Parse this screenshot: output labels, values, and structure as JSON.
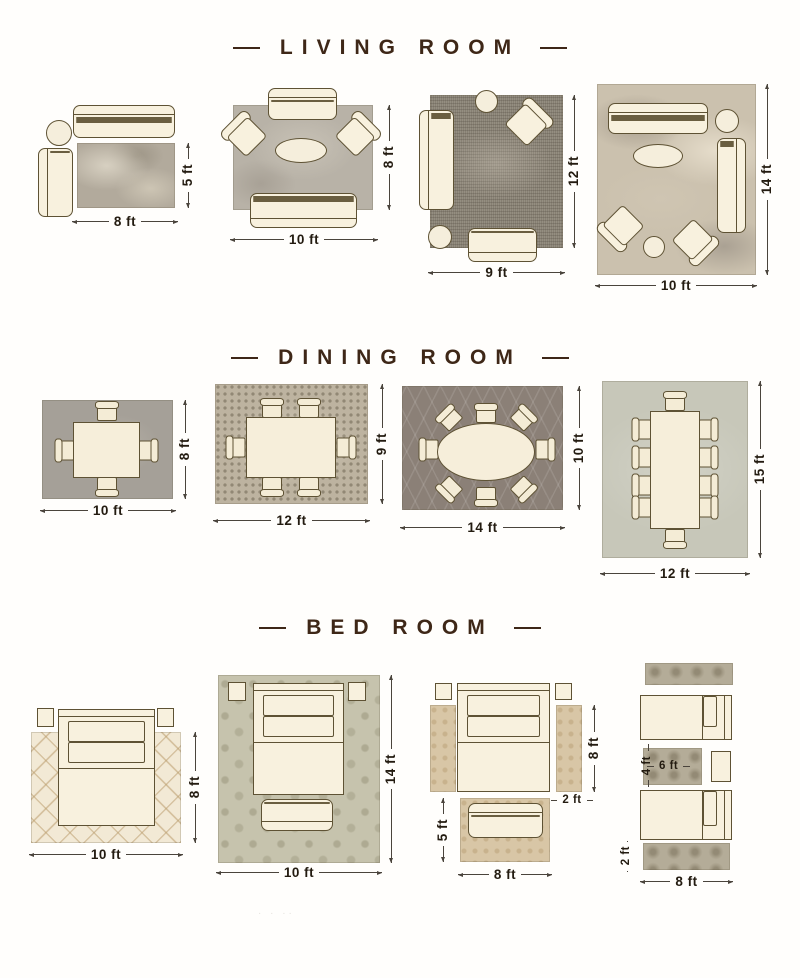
{
  "watermark": "· · ··",
  "sections": [
    {
      "title": "LIVING ROOM",
      "layouts": [
        {
          "width_label": "8 ft",
          "height_label": "5 ft",
          "furniture": [
            "sofa-3-seat",
            "round-side-table",
            "chaise"
          ],
          "rug_style": "gray-abstract"
        },
        {
          "width_label": "10 ft",
          "height_label": "8 ft",
          "furniture": [
            "loveseat",
            "armchair",
            "armchair",
            "oval-coffee-table",
            "sofa-3-seat"
          ],
          "rug_style": "gray-textured"
        },
        {
          "width_label": "9 ft",
          "height_label": "12 ft",
          "furniture": [
            "round-side-table",
            "armchair",
            "sofa-3-seat",
            "round-ottoman",
            "loveseat"
          ],
          "rug_style": "charcoal-distressed"
        },
        {
          "width_label": "10 ft",
          "height_label": "14 ft",
          "furniture": [
            "sofa-3-seat",
            "round-side-table",
            "sofa-3-seat",
            "oval-coffee-table",
            "armchair",
            "armchair",
            "round-ottoman"
          ],
          "rug_style": "beige-abstract"
        }
      ]
    },
    {
      "title": "DINING ROOM",
      "layouts": [
        {
          "width_label": "10 ft",
          "height_label": "8 ft",
          "furniture": [
            "dining-table",
            "chair-x4"
          ],
          "rug_style": "gray"
        },
        {
          "width_label": "12 ft",
          "height_label": "9 ft",
          "furniture": [
            "dining-table",
            "chair-x6"
          ],
          "rug_style": "mosaic"
        },
        {
          "width_label": "14 ft",
          "height_label": "10 ft",
          "furniture": [
            "oval-dining-table",
            "chair-x8"
          ],
          "rug_style": "dark-trellis"
        },
        {
          "width_label": "12 ft",
          "height_label": "15 ft",
          "furniture": [
            "long-dining-table",
            "chair-x10"
          ],
          "rug_style": "sage"
        }
      ]
    },
    {
      "title": "BED ROOM",
      "layouts": [
        {
          "width_label": "10 ft",
          "height_label": "8 ft",
          "furniture": [
            "nightstand",
            "nightstand",
            "queen-bed"
          ],
          "rug_style": "cream-diamond"
        },
        {
          "width_label": "10 ft",
          "height_label": "14 ft",
          "furniture": [
            "nightstand",
            "nightstand",
            "queen-bed",
            "bench"
          ],
          "rug_style": "sage-damask"
        },
        {
          "width_label": "8 ft",
          "height_label": "5 ft",
          "runner_height_label": "8 ft",
          "runner_width_label": "2 ft",
          "furniture": [
            "nightstand",
            "nightstand",
            "queen-bed",
            "runner",
            "runner",
            "bench"
          ],
          "rug_style": "tan-speckled"
        },
        {
          "width_label": "8 ft",
          "runner_width_label": "2 ft",
          "center_rug_width_label": "6 ft",
          "center_rug_height_label": "4 ft",
          "furniture": [
            "runner",
            "twin-bed",
            "accent-rug",
            "nightstand",
            "twin-bed",
            "runner"
          ],
          "rug_style": "gray-medallion"
        }
      ]
    }
  ]
}
